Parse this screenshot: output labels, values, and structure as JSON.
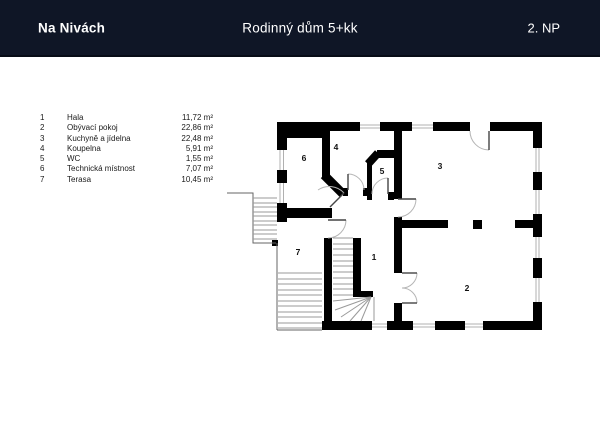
{
  "header": {
    "project": "Na Nivách",
    "title": "Rodinný dům 5+kk",
    "floor": "2. NP"
  },
  "legend": {
    "rows": [
      {
        "num": "1",
        "name": "Hala",
        "area": "11,72 m²"
      },
      {
        "num": "2",
        "name": "Obývací pokoj",
        "area": "22,86 m²"
      },
      {
        "num": "3",
        "name": "Kuchyně a jídelna",
        "area": "22,48 m²"
      },
      {
        "num": "4",
        "name": "Koupelna",
        "area": "5,91 m²"
      },
      {
        "num": "5",
        "name": "WC",
        "area": "1,55 m²"
      },
      {
        "num": "6",
        "name": "Technická místnost",
        "area": "7,07 m²"
      },
      {
        "num": "7",
        "name": "Terasa",
        "area": "10,45 m²"
      }
    ]
  },
  "plan": {
    "room_labels": [
      "1",
      "2",
      "3",
      "4",
      "5",
      "6",
      "7"
    ]
  },
  "colors": {
    "header_bg": "#0f1626",
    "header_text": "#ffffff",
    "wall": "#000000",
    "thin_line": "#666666",
    "tread_line": "#9a9a9a",
    "arc_line": "#b5b5b5",
    "text": "#1a1a1a"
  }
}
